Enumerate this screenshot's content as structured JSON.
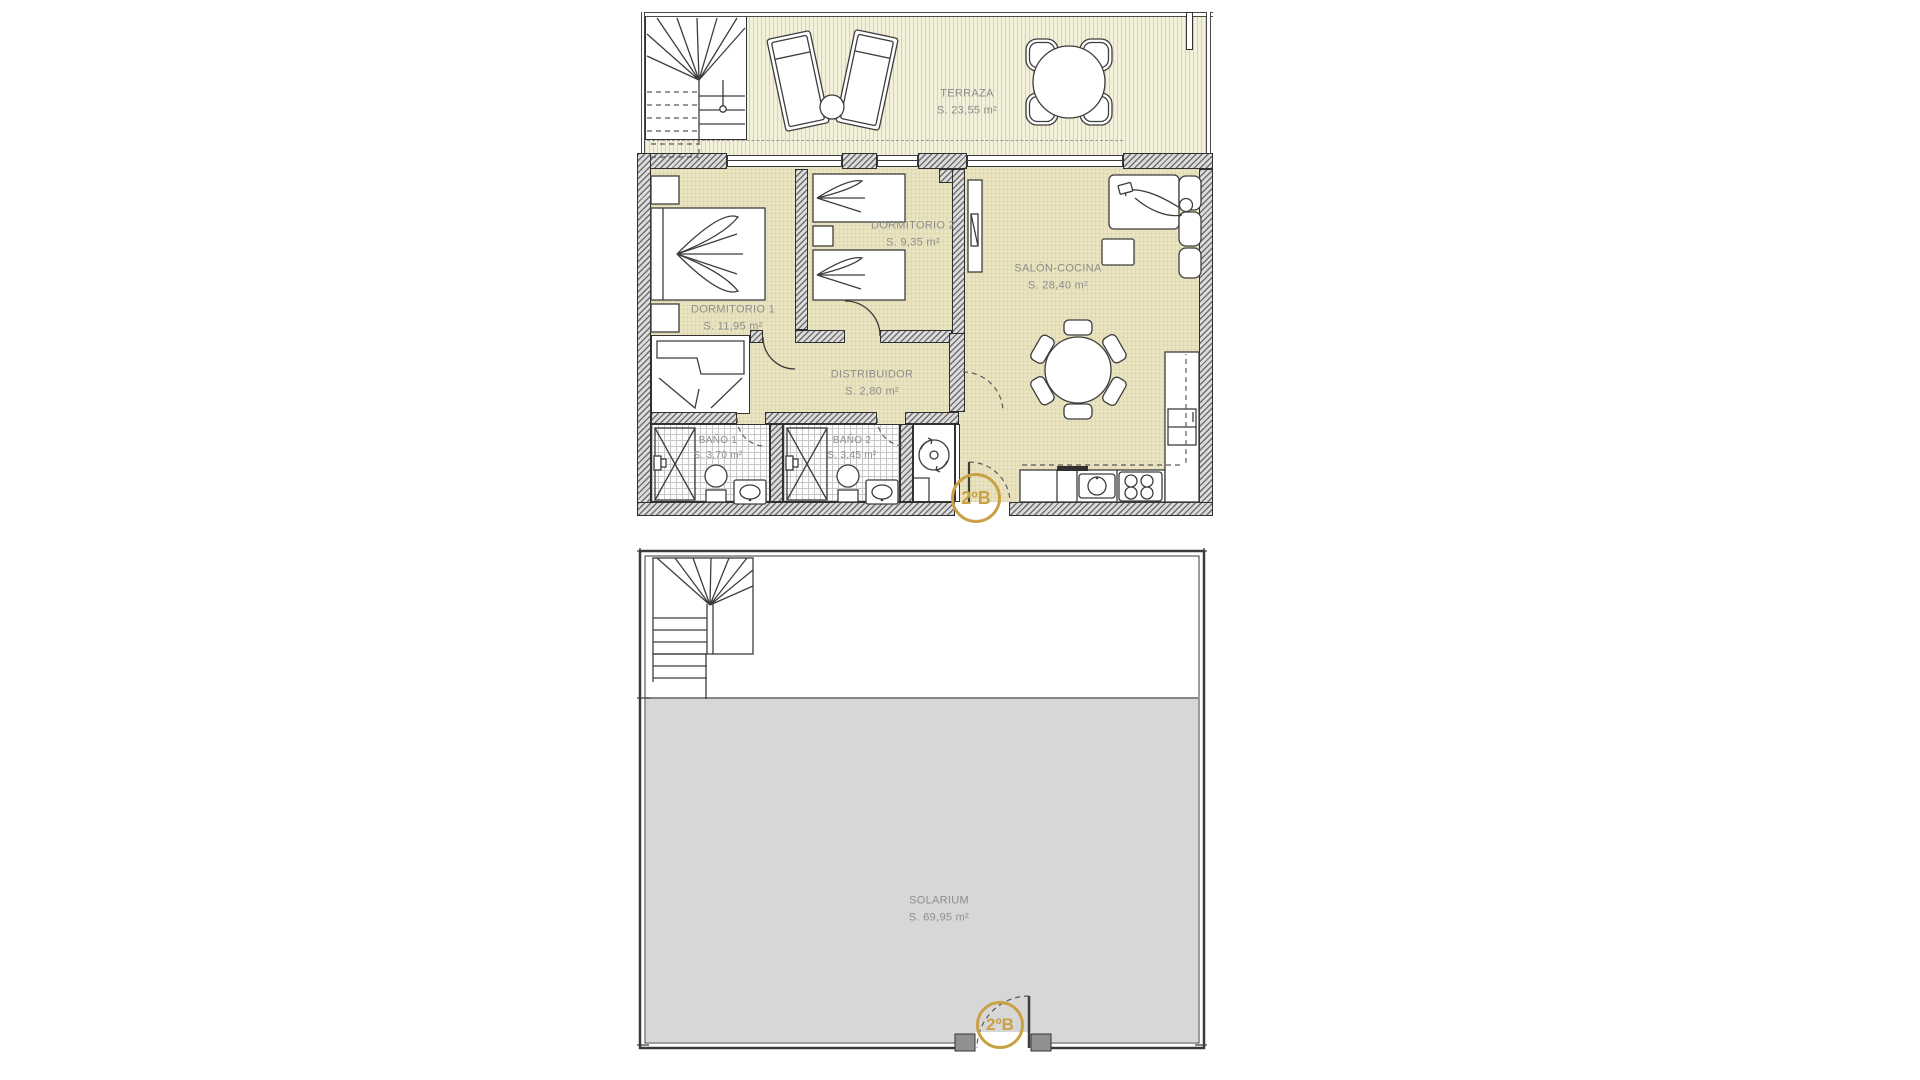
{
  "plans": {
    "upper": {
      "unit_badge": "2ºB",
      "rooms": [
        {
          "id": "terraza",
          "label": "TERRAZA",
          "area": "S. 23,55 m²"
        },
        {
          "id": "dormitorio1",
          "label": "DORMITORIO 1",
          "area": "S. 11,95 m²"
        },
        {
          "id": "dormitorio2",
          "label": "DORMITORIO 2",
          "area": "S. 9,35 m²"
        },
        {
          "id": "salon_cocina",
          "label": "SALÓN-COCINA",
          "area": "S. 28,40 m²"
        },
        {
          "id": "distribuidor",
          "label": "DISTRIBUIDOR",
          "area": "S. 2,80 m²"
        },
        {
          "id": "bano1",
          "label": "BAÑO 1",
          "area": "S. 3,70 m²"
        },
        {
          "id": "bano2",
          "label": "BAÑO 2",
          "area": "S. 3,45 m²"
        }
      ]
    },
    "lower": {
      "unit_badge": "2ºB",
      "rooms": [
        {
          "id": "solarium",
          "label": "SOLARIUM",
          "area": "S. 69,95 m²"
        }
      ]
    }
  },
  "colors": {
    "accent_badge": "#C9A245",
    "floor_apartment": "#EBE4C1",
    "floor_terrace": "#F4F1DB",
    "floor_solarium": "#D7D7D7",
    "label_gray": "#8D8D8D"
  }
}
